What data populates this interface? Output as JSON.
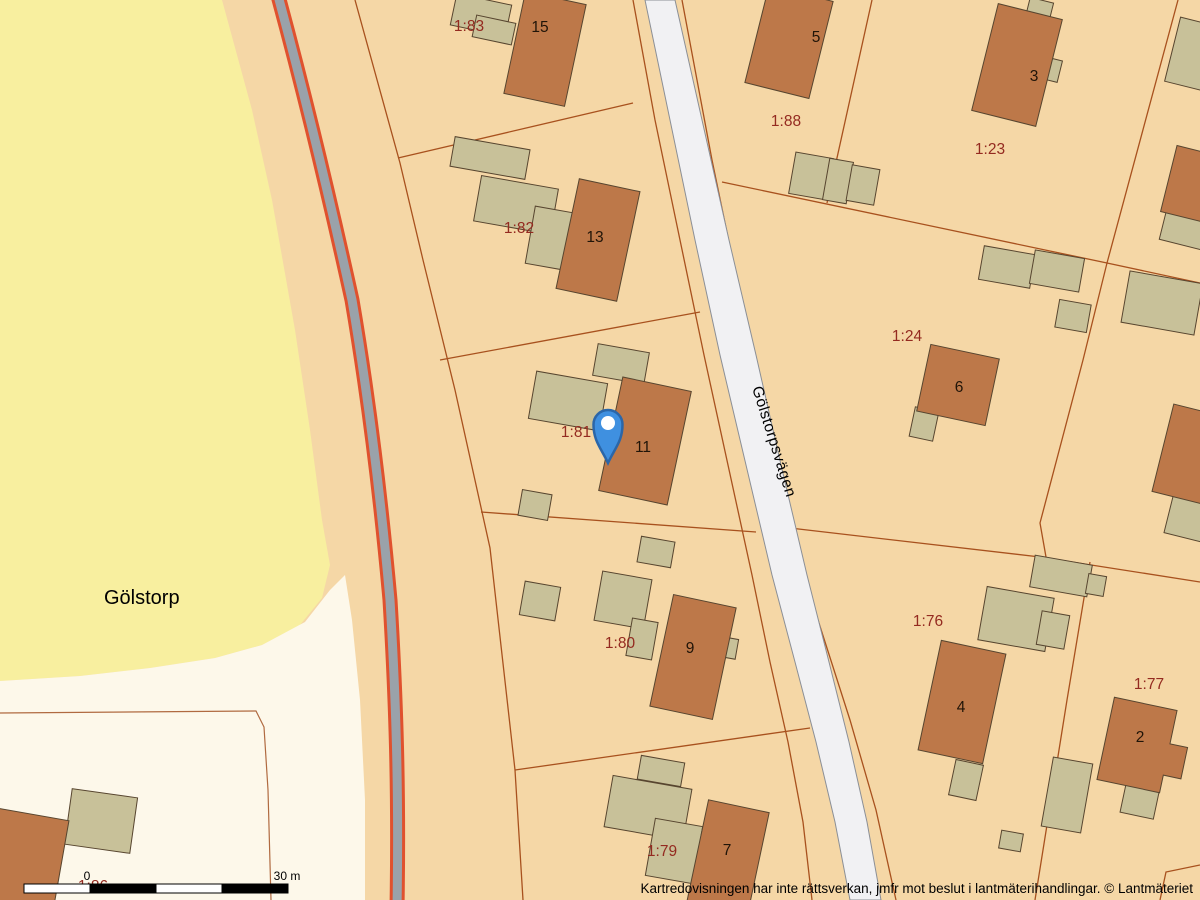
{
  "map": {
    "place_name": "Gölstorp",
    "road_name": "Gölstorpsvägen",
    "attribution": "Kartredovisningen har inte rättsverkan, jmfr mot beslut i lantmäterihandlingar. © Lantmäteriet",
    "scale_bar": {
      "start_label": "0",
      "end_label": "30 m"
    },
    "parcel_labels": [
      "1:83",
      "1:82",
      "1:81",
      "1:80",
      "1:79",
      "1:88",
      "1:23",
      "1:24",
      "1:76",
      "1:77",
      "1:86"
    ],
    "house_numbers": [
      "15",
      "13",
      "11",
      "9",
      "7",
      "5",
      "3",
      "6",
      "4",
      "2"
    ],
    "marker": {
      "name": "map-pin"
    },
    "colors": {
      "parcel_fill": "#f5d7a6",
      "field_fill": "#f8ef9f",
      "open_fill": "#fdf8ea",
      "house_fill": "#bd7849",
      "shed_fill": "#c8c199",
      "building_stroke": "#57452f",
      "boundary_stroke": "#a8511e",
      "open_boundary_stroke": "#b06a40",
      "minor_road_fill": "#9aa2aa",
      "minor_road_edge": "#e0512e",
      "major_road_fill": "#f1f1f3",
      "major_road_edge": "#8b8f96",
      "parcel_label": "#942a20",
      "house_label": "#201408",
      "text_black": "#000000",
      "marker_fill": "#3f90e0",
      "marker_stroke": "#2b66a8"
    }
  }
}
